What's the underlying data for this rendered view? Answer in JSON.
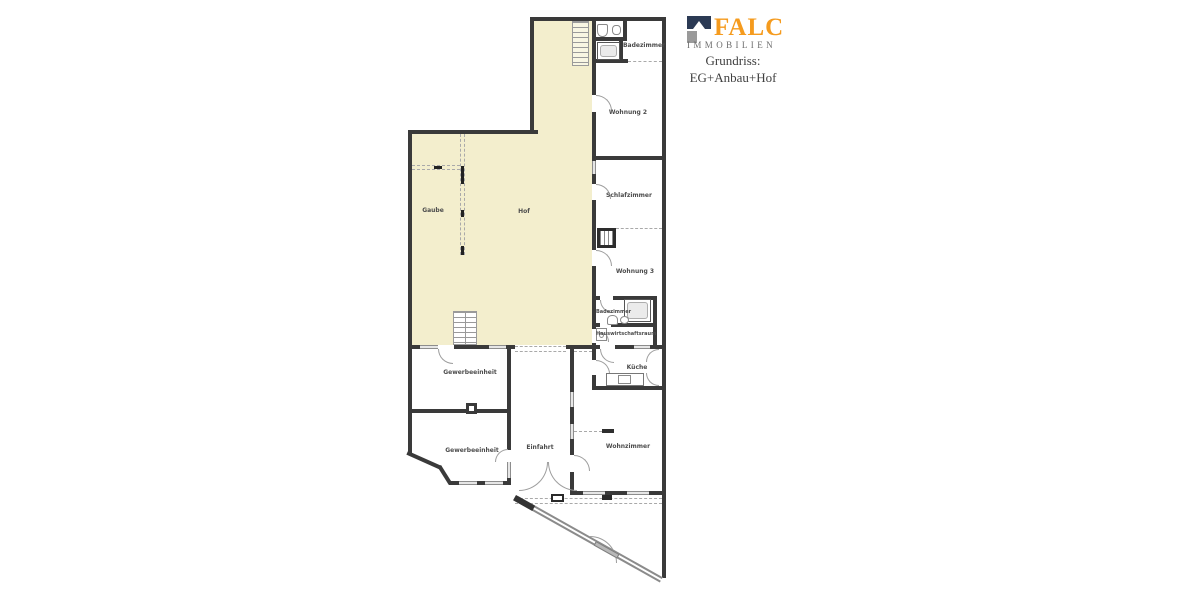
{
  "header": {
    "brand": "FALC",
    "brand_sub": "IMMOBILIEN",
    "title_line1": "Grundriss:",
    "title_line2": "EG+Anbau+Hof"
  },
  "colors": {
    "accent_orange": "#F59B1E",
    "logo_navy": "#2B3A54",
    "logo_gray": "#9A9A9A",
    "hof_fill": "#F3EECD",
    "wall": "#3A3A3A"
  },
  "rooms": [
    {
      "id": "badezimmer-og",
      "label": "Badezimmer"
    },
    {
      "id": "wohnung-2",
      "label": "Wohnung 2"
    },
    {
      "id": "schlafzimmer",
      "label": "Schlafzimmer"
    },
    {
      "id": "wohnung-3",
      "label": "Wohnung 3"
    },
    {
      "id": "badezimmer-wohnung3",
      "label": "Badezimmer"
    },
    {
      "id": "hauswirtschaftsraum",
      "label": "Hauswirtschaftsraum"
    },
    {
      "id": "kueche",
      "label": "Küche"
    },
    {
      "id": "wohnzimmer",
      "label": "Wohnzimmer"
    },
    {
      "id": "gaube",
      "label": "Gaube"
    },
    {
      "id": "hof",
      "label": "Hof"
    },
    {
      "id": "gewerbeeinheit-1",
      "label": "Gewerbeeinheit"
    },
    {
      "id": "gewerbeeinheit-2",
      "label": "Gewerbeeinheit"
    },
    {
      "id": "einfahrt",
      "label": "Einfahrt"
    }
  ]
}
